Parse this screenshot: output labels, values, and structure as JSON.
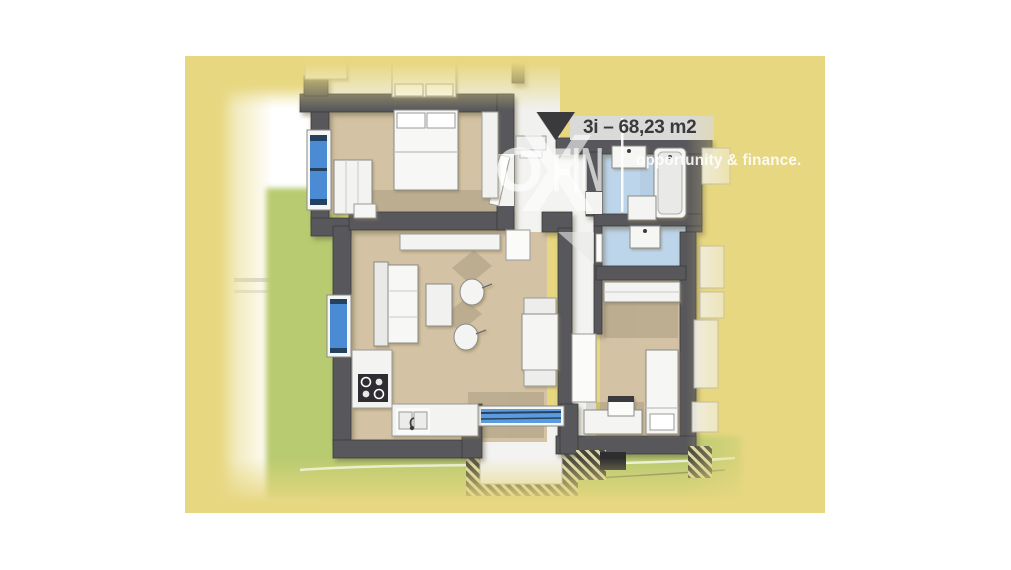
{
  "floorplan": {
    "area_label": "3i – 68,23 m2",
    "entrance_marker": "triangle-down",
    "watermark": {
      "brand_o": "O",
      "brand_x": "X",
      "brand_fin": "FIN",
      "tagline": "opportunity & finance."
    },
    "colors": {
      "page_background": "#ffffff",
      "card_yellow": "#e7d780",
      "wall": "#58585b",
      "floor_rooms": "#d3c2a3",
      "floor_bathroom": "#bdd5eb",
      "floor_hall": "#f3f3f1",
      "lawn_green": "#b8cb70",
      "window_glass": "#4a8bd4",
      "label_bar": "#dadad8",
      "label_text": "#3a3a3c",
      "watermark_white": "#ffffff"
    }
  }
}
